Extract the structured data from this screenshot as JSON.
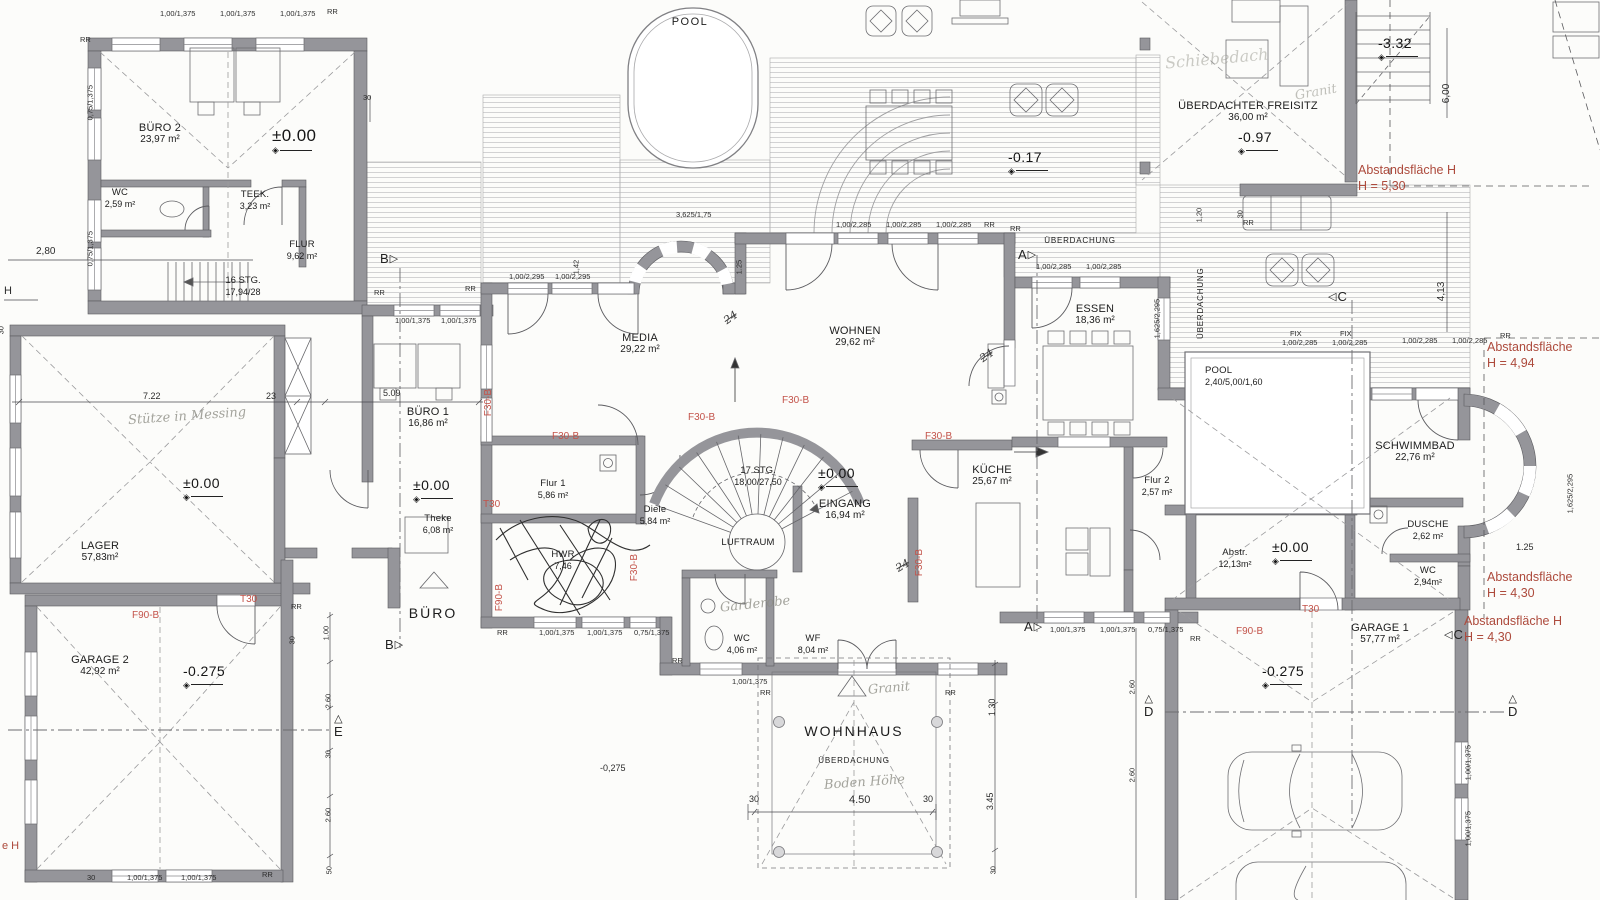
{
  "rooms": {
    "buero2": {
      "name": "BÜRO 2",
      "area": "23,97 m²"
    },
    "wc_buero2": {
      "name": "WC",
      "area": "2,59 m²"
    },
    "teek": {
      "name": "TEEK.",
      "area": "3,23 m²"
    },
    "flur": {
      "name": "FLUR",
      "area": "9,62 m²"
    },
    "media": {
      "name": "MEDIA",
      "area": "29,22 m²"
    },
    "wohnen": {
      "name": "WOHNEN",
      "area": "29,62 m²"
    },
    "essen": {
      "name": "ESSEN",
      "area": "18,36 m²"
    },
    "buero1": {
      "name": "BÜRO 1",
      "area": "16,86 m²"
    },
    "lager": {
      "name": "LAGER",
      "area": "57,83m²"
    },
    "theke": {
      "name": "Theke",
      "area": "6,08 m²"
    },
    "flur1": {
      "name": "Flur 1",
      "area": "5,86 m²"
    },
    "diele": {
      "name": "Diele",
      "area": "5,84 m²"
    },
    "luftraum": {
      "name": "LUFTRAUM",
      "area": ""
    },
    "eingang": {
      "name": "EINGANG",
      "area": "16,94 m²"
    },
    "kueche": {
      "name": "KÜCHE",
      "area": "25,67 m²"
    },
    "hwr": {
      "name": "HWR",
      "area": "7,46"
    },
    "wc_eg": {
      "name": "WC",
      "area": "4,06 m²"
    },
    "wf": {
      "name": "WF",
      "area": "8,04 m²"
    },
    "pool_indoor": {
      "name": "POOL",
      "area": "2,40/5,00/1,60"
    },
    "schwimmbad": {
      "name": "SCHWIMMBAD",
      "area": "22,76 m²"
    },
    "flur2": {
      "name": "Flur 2",
      "area": "2,57 m²"
    },
    "dusche": {
      "name": "DUSCHE",
      "area": "2,62 m²"
    },
    "abstellraum": {
      "name": "Abstr.",
      "area": "12,13m²"
    },
    "wc_pool": {
      "name": "WC",
      "area": "2,94m²"
    },
    "garage1": {
      "name": "GARAGE 1",
      "area": "57,77 m²"
    },
    "garage2": {
      "name": "GARAGE 2",
      "area": "42,92 m²"
    },
    "freisitz": {
      "name": "ÜBERDACHTER FREISITZ",
      "area": "36,00 m²"
    }
  },
  "stairs": {
    "stair_buero": {
      "label": "16 STG.",
      "dims": "17,94/28"
    },
    "stair_main": {
      "label": "17 STG.",
      "dims": "18,00/27,50"
    }
  },
  "site": {
    "pool_outdoor": "POOL",
    "buero": "BÜRO",
    "wohnhaus": "WOHNHAUS",
    "ueberdachung": "ÜBERDACHUNG"
  },
  "levels": {
    "l_buero2": "±0.00",
    "l_terrace": "-0.17",
    "l_freisitz": "-0.97",
    "l_garden": "-3.32",
    "l_lager": "±0.00",
    "l_theke": "±0.00",
    "l_eingang": "±0.00",
    "l_abstell": "±0.00",
    "l_garage2": "-0.275",
    "l_garage1": "-0.275",
    "l_porch": "-0,275"
  },
  "fire_ratings": {
    "t30": "T30",
    "f30": "F30-B",
    "f90": "F90-B"
  },
  "setbacks": {
    "s1": {
      "line1": "Abstandsfläche H",
      "line2": "H = 5,30"
    },
    "s2": {
      "line1": "Abstandsfläche",
      "line2": "H = 4,94"
    },
    "s3": {
      "line1": "Abstandsfläche",
      "line2": "H = 4,30"
    },
    "s4": {
      "line1": "Abstandsfläche H",
      "line2": "H = 4,30"
    },
    "left_fragment": "e H"
  },
  "sections": {
    "a": "A",
    "b": "B",
    "c": "C",
    "d": "D",
    "e": "E"
  },
  "dimensions": {
    "win_100_1375": "1,00/1,375",
    "win_075_1375": "0,75/1,375",
    "win_100_2295": "1,00/2,295",
    "win_100_2285": "1,00/2,285",
    "win_1625_2295": "1,625/2,295",
    "win_3625_175": "3,625/1,75",
    "fix": "FIX",
    "rr": "RR",
    "d_30": "30",
    "d_50": "50",
    "d_280": "2,80",
    "d_722": "7.22",
    "d_23": "23",
    "d_509": "5.09",
    "d_125": "1.25",
    "d_142": "1,42",
    "d_120": "1,20",
    "d_100": "1.00",
    "d_260": "2.60",
    "d_600": "6,00",
    "d_413": "4,13",
    "d_450": "4.50",
    "d_130": "1.30",
    "d_345": "3.45",
    "h": "H"
  },
  "handwriting": {
    "note_lager": "Stütze in Messing",
    "note_freisitz": "Schiebedach",
    "note_granit": "Granit",
    "note_garderobe": "Garderobe",
    "note_hoehe": "Boden Höhe",
    "note_24": "24"
  }
}
